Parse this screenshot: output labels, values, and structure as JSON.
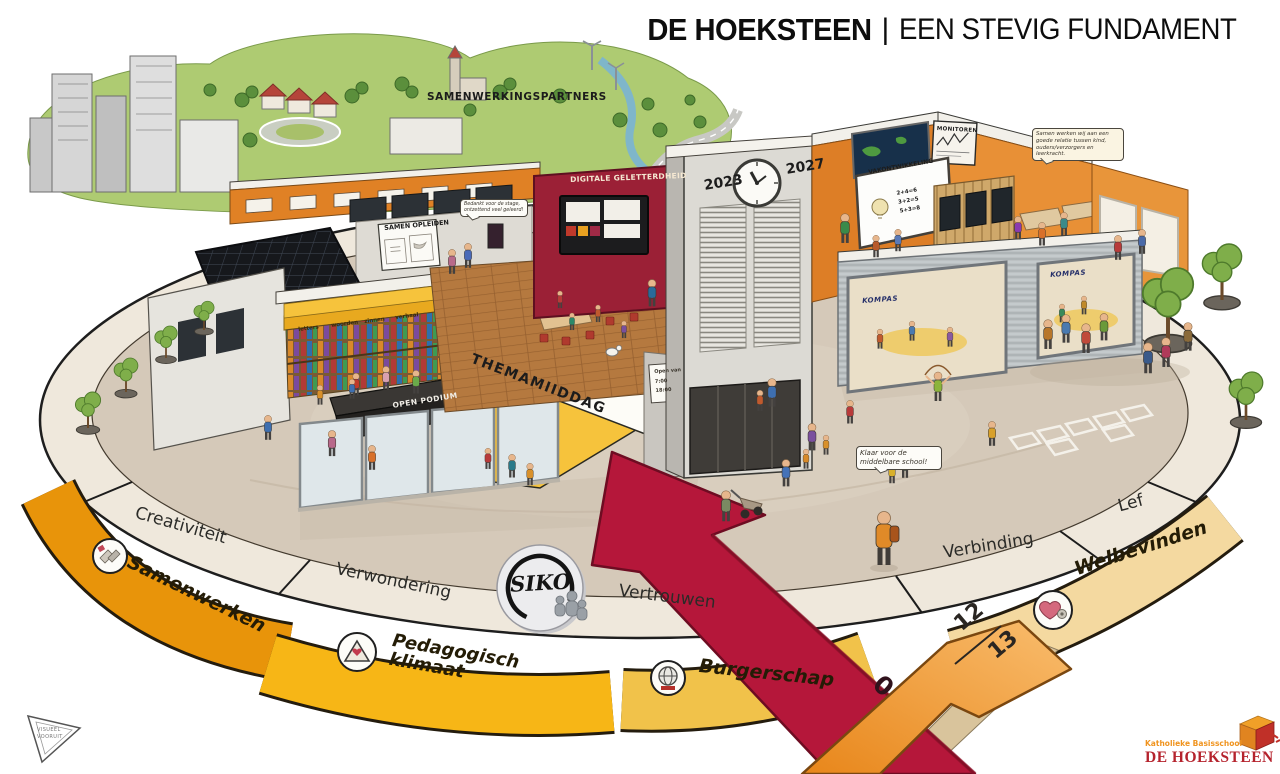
{
  "title": {
    "bold": "DE HOEKSTEEN",
    "sep": "|",
    "light": "EEN STEVIG FUNDAMENT"
  },
  "landscape": {
    "label": "SAMENWERKINGSPARTNERS"
  },
  "timeline": {
    "start": "2023",
    "end": "2027"
  },
  "building": {
    "digital_wall_title": "DIGITALE GELETTERDHEID",
    "samen_opleiden": "SAMEN OPLEIDEN",
    "vakontwikkeling": "VAKONTWIKKELING",
    "sums": "2+4=6\n3+2=5\n5+3=8",
    "monitoren": "MONITOREN",
    "kompas": "KOMPAS",
    "themamiddag": "THEMAMIIDDAG",
    "open_podium": "OPEN PODIUM",
    "shelf_labels": [
      "letters",
      "woorden",
      "zinnen",
      "verhaal"
    ],
    "door_sign": "Open van\n7:00\n18:00"
  },
  "bubbles": {
    "stage": "Bedankt voor de stage, ontzettend veel geleerd!",
    "relatie": "Samen werken wij aan een goede relatie tussen kind, ouders/verzorgers en leerkracht.",
    "middelbare": "Klaar voor de middelbare school!"
  },
  "ring": [
    "Creativiteit",
    "Verwondering",
    "Vertrouwen",
    "Verbinding",
    "Lef"
  ],
  "ribbons": [
    {
      "label": "Samenwerken",
      "color": "#e8940a"
    },
    {
      "label": "Pedagogisch klimaat",
      "color": "#f7b616"
    },
    {
      "label": "Burgerschap",
      "color": "#f1c24a"
    },
    {
      "label": "Welbevinden",
      "color": "#f4d9a0"
    }
  ],
  "siko": "SIKO",
  "arrow_numbers": {
    "start": "0",
    "top": "12",
    "bottom": "13"
  },
  "logos": {
    "visueel": "VISUEEL\nVOORUIT",
    "school_small": "Katholieke Basisschool",
    "school_large": "DE HOEKSTEEN"
  },
  "colors": {
    "arrow_red": "#b5173a",
    "arrow_orange": "#f0941f",
    "wall_red": "#9b2036",
    "wall_orange": "#e0832b",
    "wall_yellow": "#f6c33c",
    "platform": "#d5c9ba",
    "green": "#a8c96a",
    "logo_red": "#b5232d"
  }
}
